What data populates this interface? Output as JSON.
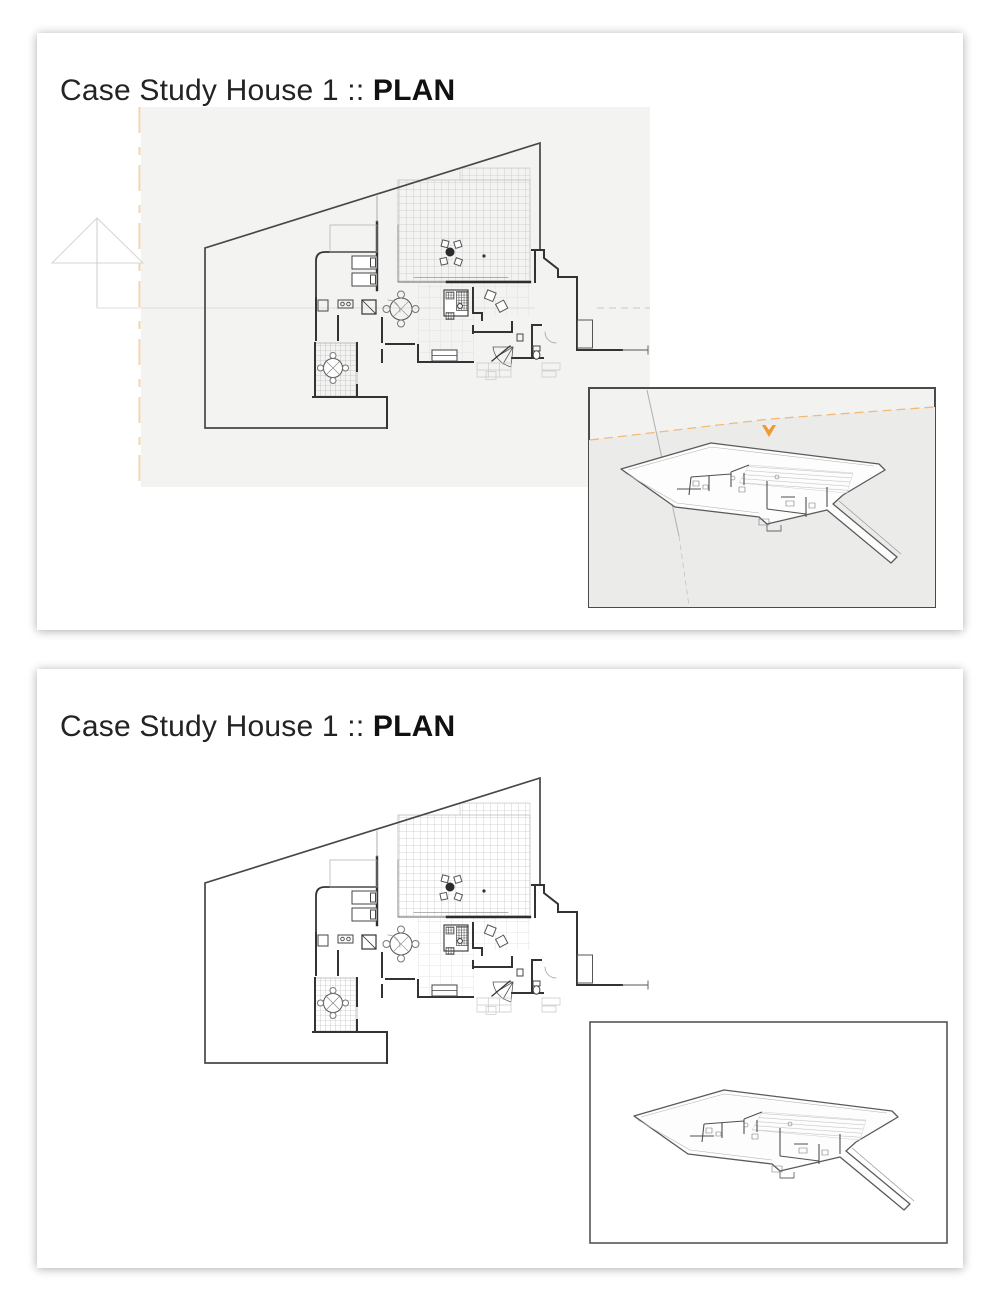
{
  "panels": [
    {
      "title_text": "Case Study House 1 :: ",
      "title_emphasis": "PLAN",
      "viewport_background": "#f3f3f2",
      "inset_background": "#f2f2f1"
    },
    {
      "title_text": "Case Study House 1 :: ",
      "title_emphasis": "PLAN",
      "viewport_background": "#ffffff",
      "inset_background": "#ffffff"
    }
  ],
  "colors": {
    "accent_orange": "#ee9933",
    "guide_orange_pale": "#f0d4ac",
    "boundary_line": "#474747",
    "wall_line": "#333333",
    "grid_line": "#c6c6c6",
    "viewport_gray": "#f3f3f2",
    "inset_ground_gray": "#ebebe9",
    "card_background": "#ffffff"
  },
  "icons": {
    "camera_arrow": "orange downward arrow",
    "section_marker": "triangle guide marker"
  }
}
